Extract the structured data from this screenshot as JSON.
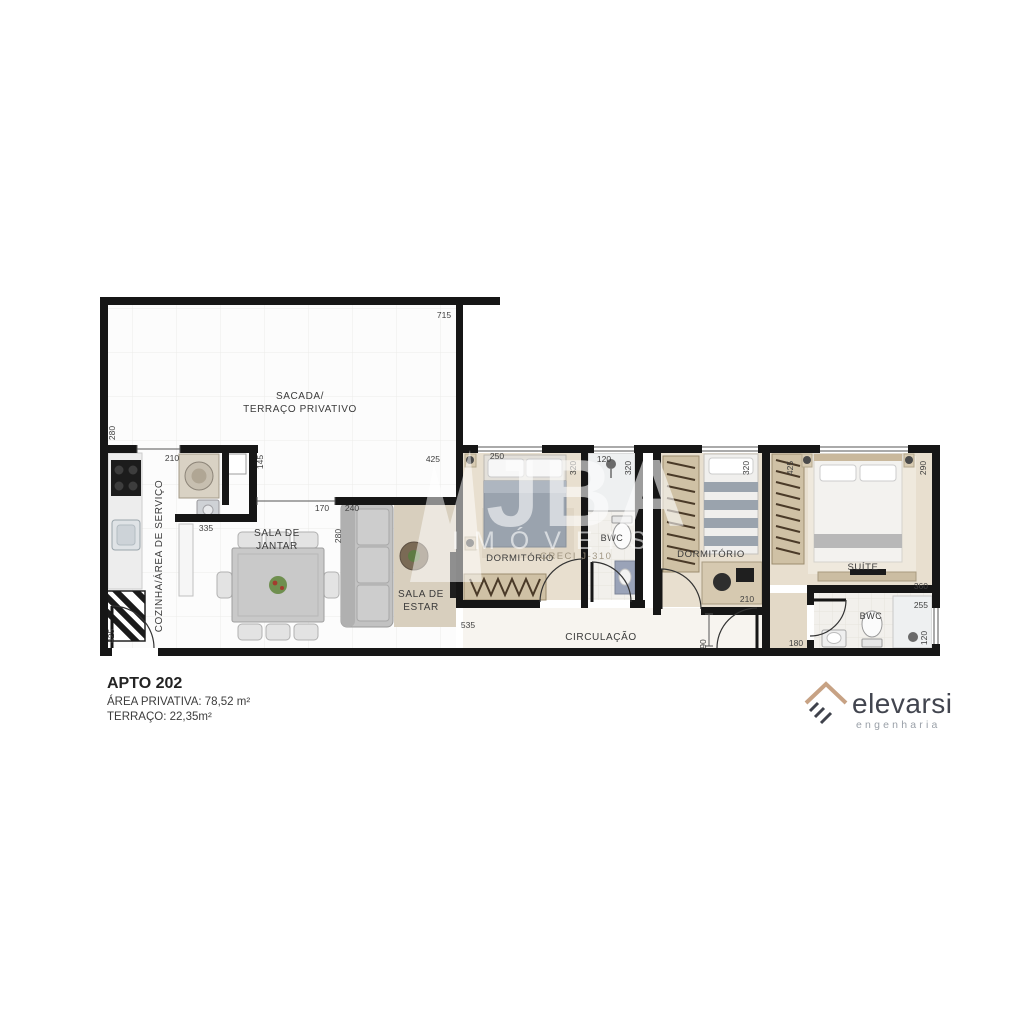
{
  "apartment": {
    "name": "APTO 202",
    "private_area": "ÁREA PRIVATIVA: 78,52 m²",
    "terrace_area": "TERRAÇO: 22,35m²"
  },
  "brand": {
    "name": "elevarsi",
    "tagline": "engenharia"
  },
  "watermark": {
    "initials": "JBA",
    "word": "IMÓVEIS",
    "license": "CRECI J-310"
  },
  "colors": {
    "wall": "#161616",
    "floor_beige": "#e8dfcf",
    "logo_roof": "#c7a284",
    "brand_text": "#42454f",
    "brand_sub": "#9aa0a8"
  },
  "rooms": {
    "terrace_line1": "SACADA/",
    "terrace_line2": "TERRAÇO PRIVATIVO",
    "kitchen": "COZINHA/ÁREA DE SERVIÇO",
    "dining_line1": "SALA DE",
    "dining_line2": "JANTAR",
    "living_line1": "SALA DE",
    "living_line2": "ESTAR",
    "bedroom1": "DORMITÓRIO",
    "bathroom1": "BWC",
    "bedroom2": "DORMITÓRIO",
    "suite": "SUÍTE",
    "bathroom2": "BWC",
    "hallway": "CIRCULAÇÃO"
  },
  "dims": {
    "terrace_width": "715",
    "terrace_side": "280",
    "laundry_width": "210",
    "pantry_side": "145",
    "living_top": "425",
    "bedroom1_width": "250",
    "bedroom1_depth": "320",
    "bathroom1_width": "120",
    "bathroom1_depth": "320",
    "passage": "170",
    "living_wall": "240",
    "living_depth": "280",
    "kitchen_run": "335",
    "bedroom2_depth": "320",
    "suite_side": "425",
    "suite_width": "290",
    "hall_run": "535",
    "desk_width": "210",
    "tv_wall": "360",
    "bathroom2_width": "255",
    "bathroom2_run": "180",
    "bathroom2_depth": "120",
    "hall_door": "90",
    "entry_door": "425"
  }
}
